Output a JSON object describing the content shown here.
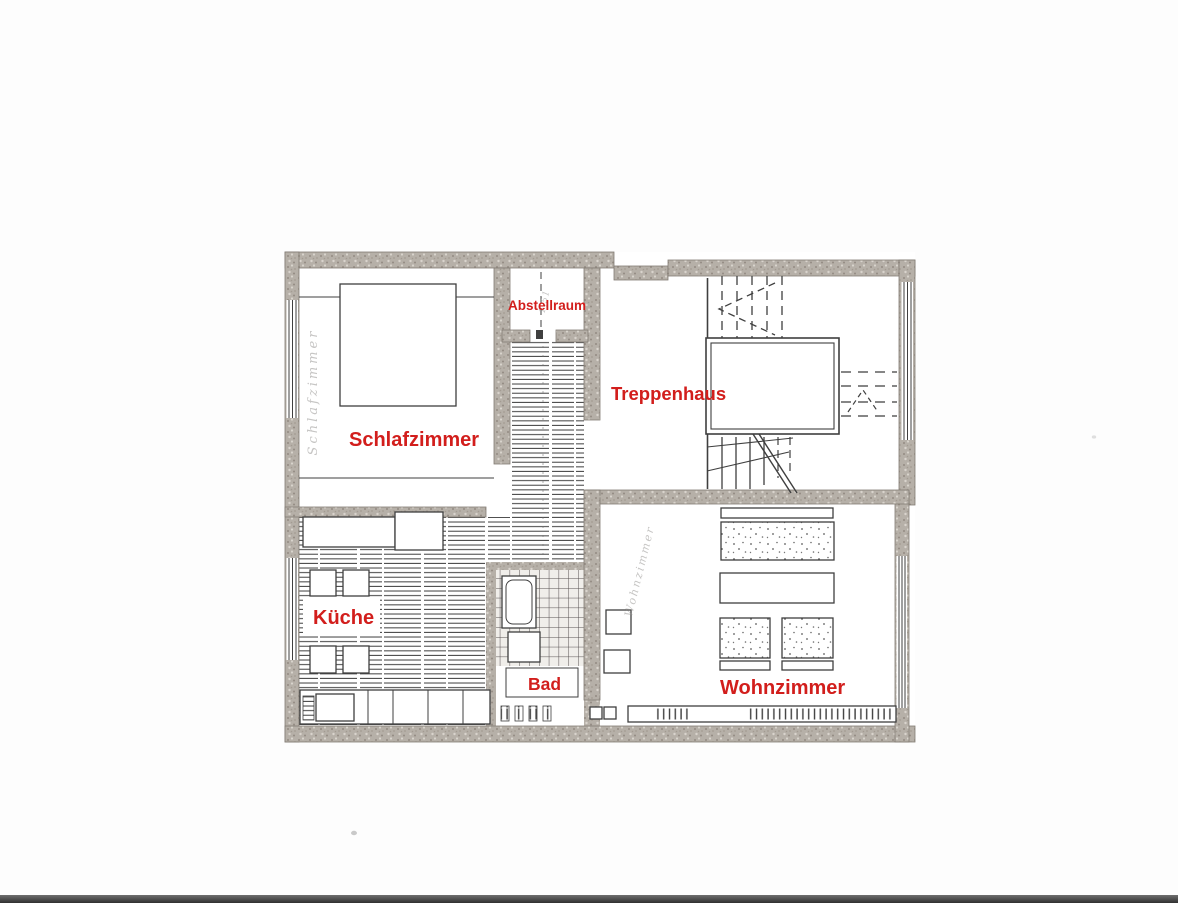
{
  "rooms": {
    "schlafzimmer": "Schlafzimmer",
    "abstellraum": "Abstellraum",
    "treppenhaus": "Treppenhaus",
    "kueche": "Küche",
    "bad": "Bad",
    "wohnzimmer": "Wohnzimmer"
  },
  "pencil": {
    "schlafzimmer_vertical": "Schlafzimmer",
    "wohnzimmer_diagonal": "Wohnzimmer",
    "abstellraum_note": "1,51"
  },
  "colors": {
    "label_red": "#d21e1c",
    "wall_gray": "#b6b0a8",
    "ink": "#3f3f3f",
    "scan_bar": "#303030"
  }
}
